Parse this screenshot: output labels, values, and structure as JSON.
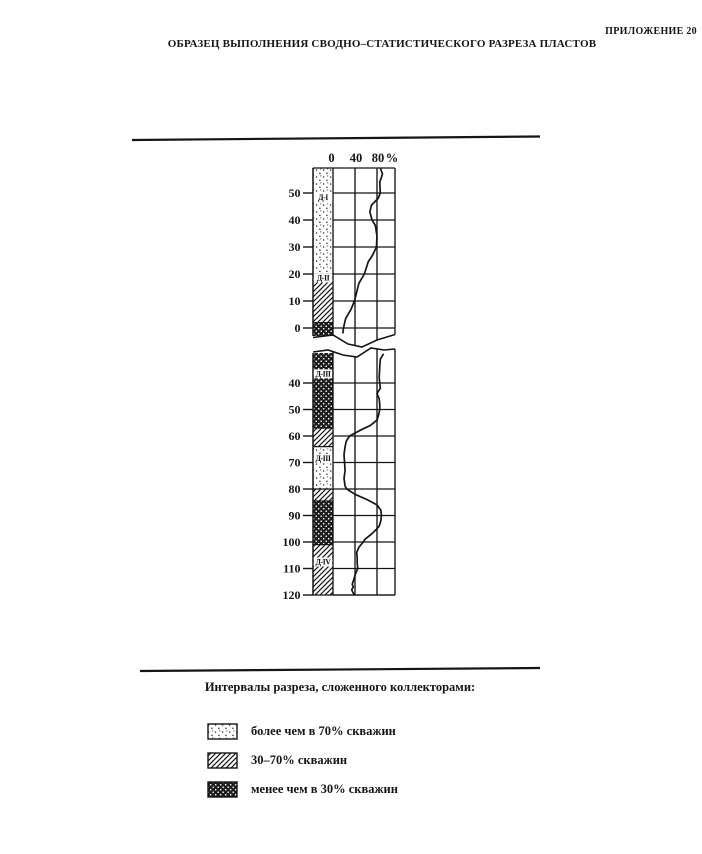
{
  "page": {
    "appendix_label": "ПРИЛОЖЕНИЕ 20",
    "title": "ОБРАЗЕЦ ВЫПОЛНЕНИЯ СВОДНО–СТАТИСТИЧЕСКОГО РАЗРЕЗА ПЛАСТОВ"
  },
  "colors": {
    "ink": "#151515",
    "paper": "#ffffff"
  },
  "chart_data": {
    "type": "line",
    "title": "Сводно-статистический разрез пластов",
    "x_axis": {
      "ticks": [
        0,
        40,
        80
      ],
      "unit": "%",
      "range": [
        0,
        112
      ]
    },
    "grid": true,
    "pattern_key": {
      "dotted": "более чем в 70% скважин",
      "diagonal": "30–70% скважин",
      "crosshatch": "менее чем в 30% скважин"
    },
    "panels": [
      {
        "name": "upper",
        "depth_ticks": [
          50,
          40,
          30,
          20,
          10,
          0
        ],
        "blocks": [
          {
            "label": "Д-I",
            "pattern": "dotted",
            "from": 59.3,
            "to": 20,
            "label_at": 47.5
          },
          {
            "label": "Д-II",
            "pattern": "diagonal",
            "from": 20,
            "to": 2,
            "label_at": 17.6
          },
          {
            "label": "",
            "pattern": "crosshatch",
            "from": 2,
            "to": -3.3,
            "label_at": null
          }
        ],
        "curve": [
          [
            59.3,
            86
          ],
          [
            57,
            90
          ],
          [
            54,
            85
          ],
          [
            50,
            86
          ],
          [
            48,
            82
          ],
          [
            45.5,
            70
          ],
          [
            43,
            67
          ],
          [
            40,
            71
          ],
          [
            38,
            77
          ],
          [
            34,
            80
          ],
          [
            30,
            79
          ],
          [
            27,
            72
          ],
          [
            24.5,
            64
          ],
          [
            20,
            57
          ],
          [
            16.5,
            47
          ],
          [
            14,
            44
          ],
          [
            10,
            39
          ],
          [
            7,
            33
          ],
          [
            3.5,
            23
          ],
          [
            0,
            19
          ],
          [
            -2,
            18
          ]
        ]
      },
      {
        "name": "lower",
        "depth_ticks": [
          40,
          50,
          60,
          70,
          80,
          90,
          100,
          110,
          120
        ],
        "blocks": [
          {
            "label": "Д-III",
            "pattern": "crosshatch",
            "from": 28.3,
            "to": 57,
            "label_at": 37.5
          },
          {
            "label": "",
            "pattern": "diagonal",
            "from": 57,
            "to": 64,
            "label_at": null
          },
          {
            "label": "Д-III",
            "pattern": "dotted",
            "from": 64,
            "to": 80,
            "label_at": 69.5
          },
          {
            "label": "",
            "pattern": "diagonal",
            "from": 80,
            "to": 84.5,
            "label_at": null
          },
          {
            "label": "",
            "pattern": "crosshatch",
            "from": 84.5,
            "to": 101,
            "label_at": null
          },
          {
            "label": "Д-IV",
            "pattern": "diagonal",
            "from": 101,
            "to": 120,
            "label_at": 108.5
          }
        ],
        "curve": [
          [
            29,
            92
          ],
          [
            31,
            86
          ],
          [
            34,
            85
          ],
          [
            38,
            84
          ],
          [
            40,
            85
          ],
          [
            42,
            86
          ],
          [
            44,
            80
          ],
          [
            46,
            84
          ],
          [
            48,
            85
          ],
          [
            50,
            85
          ],
          [
            52,
            83
          ],
          [
            54,
            80
          ],
          [
            56,
            68
          ],
          [
            58,
            48
          ],
          [
            60,
            30
          ],
          [
            62,
            24
          ],
          [
            64,
            22
          ],
          [
            67,
            20
          ],
          [
            70,
            21
          ],
          [
            73,
            22
          ],
          [
            76,
            20
          ],
          [
            79,
            22
          ],
          [
            80,
            25
          ],
          [
            82,
            40
          ],
          [
            84,
            62
          ],
          [
            86,
            80
          ],
          [
            88,
            87
          ],
          [
            90,
            88
          ],
          [
            92,
            87
          ],
          [
            94,
            84
          ],
          [
            95,
            80
          ],
          [
            97,
            70
          ],
          [
            99,
            58
          ],
          [
            100,
            55
          ],
          [
            102,
            47
          ],
          [
            104,
            43
          ],
          [
            106,
            44
          ],
          [
            108,
            44
          ],
          [
            110,
            45
          ],
          [
            112,
            41
          ],
          [
            114,
            38
          ],
          [
            116,
            35
          ],
          [
            117,
            37
          ],
          [
            118,
            34
          ],
          [
            119,
            36
          ],
          [
            120,
            39
          ]
        ]
      }
    ]
  },
  "legend": {
    "caption": "Интервалы разреза, сложенного коллекторами:",
    "items": [
      {
        "pattern": "dotted",
        "label": "более чем в 70% скважин"
      },
      {
        "pattern": "diagonal",
        "label": "30–70% скважин"
      },
      {
        "pattern": "crosshatch",
        "label": "менее чем в 30% скважин"
      }
    ]
  }
}
